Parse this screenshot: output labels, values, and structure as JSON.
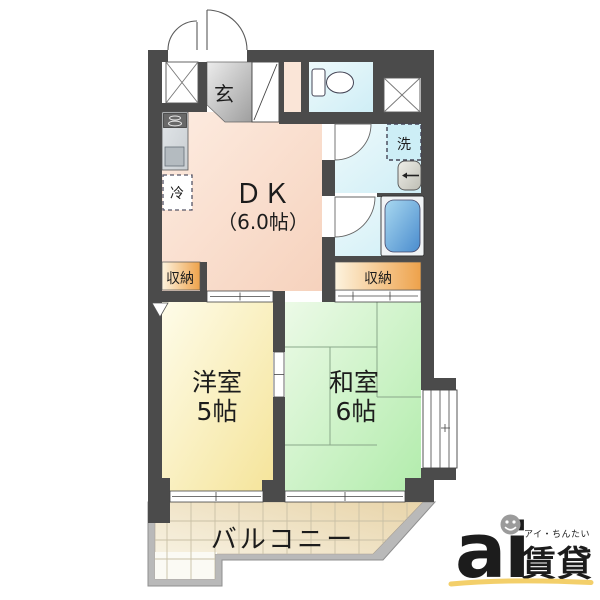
{
  "labels": {
    "genkan": "玄",
    "fridge": "冷",
    "dk": "ＤＫ",
    "dk_size": "（6.0帖）",
    "washer": "洗",
    "closet_left": "収納",
    "closet_right": "収納",
    "western_label": "洋室",
    "western_size": "5帖",
    "japanese_label": "和室",
    "japanese_size": "6帖",
    "balcony": "バルコニー"
  },
  "logo": {
    "brand": "ai",
    "reading": "アイ・ちんたい",
    "kanji": "賃貸"
  },
  "colors": {
    "wall": "#4b4b4b",
    "railing": "#b9b9b9",
    "dk_floor": "#f8dcc9",
    "western_floor": "#f5e49a",
    "japanese_floor": "#b2ecac",
    "closet": "#eea24b",
    "water_area": "#cfeef6",
    "bathtub": "#4a8cce",
    "balcony_floor": "#e8d4a9",
    "genkan_floor": "#c9c9c9",
    "logo_gray": "#9b9b9b",
    "logo_orange": "#f0953c",
    "logo_underline": "#f3cf6a"
  }
}
